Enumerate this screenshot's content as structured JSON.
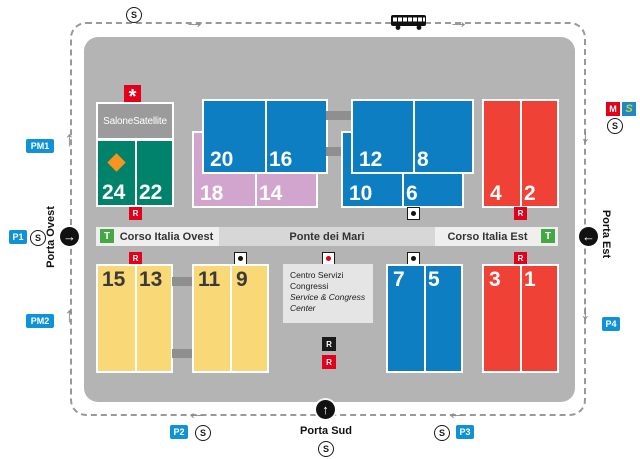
{
  "colors": {
    "map_bg": "#b4b4b4",
    "hall_blue": "#0d7ec1",
    "hall_teal": "#00836a",
    "hall_pink": "#d2a5ce",
    "hall_red": "#ef4136",
    "hall_yellow": "#f9d877",
    "accent_red": "#e2001a",
    "parking_blue": "#0f93d6",
    "tram_green": "#45a844",
    "srail_blue": "#1e88c9",
    "srail_letter_green": "#c5d92e",
    "diamond_orange": "#f7941d"
  },
  "gates": {
    "west": "Porta Ovest",
    "south": "Porta Sud",
    "east": "Porta Est"
  },
  "parking": {
    "pm1": "PM1",
    "pm2": "PM2",
    "p1": "P1",
    "p2": "P2",
    "p3": "P3",
    "p4": "P4"
  },
  "streets": {
    "ovest": "Corso Italia Ovest",
    "ponte": "Ponte dei Mari",
    "est": "Corso Italia Est"
  },
  "buildings": {
    "salone_satellite": "SaloneSatellite",
    "centro_servizi_l1": "Centro Servizi",
    "centro_servizi_l2": "Congressi",
    "centro_servizi_l3": "Service & Congress",
    "centro_servizi_l4": "Center"
  },
  "halls": {
    "h24": "24",
    "h22": "22",
    "h20": "20",
    "h18": "18",
    "h16": "16",
    "h14": "14",
    "h12": "12",
    "h10": "10",
    "h8": "8",
    "h6": "6",
    "h4": "4",
    "h2": "2",
    "h15": "15",
    "h13": "13",
    "h11": "11",
    "h9": "9",
    "h7": "7",
    "h5": "5",
    "h3": "3",
    "h1": "1"
  },
  "transport": {
    "suburban": "S",
    "metro": "M",
    "srail": "S",
    "tram": "T"
  },
  "symbols": {
    "restaurant": "R",
    "asterisk": "*",
    "arrow_up": "↑",
    "arrow_down": "↓",
    "arrow_left": "←",
    "arrow_right": "→"
  }
}
